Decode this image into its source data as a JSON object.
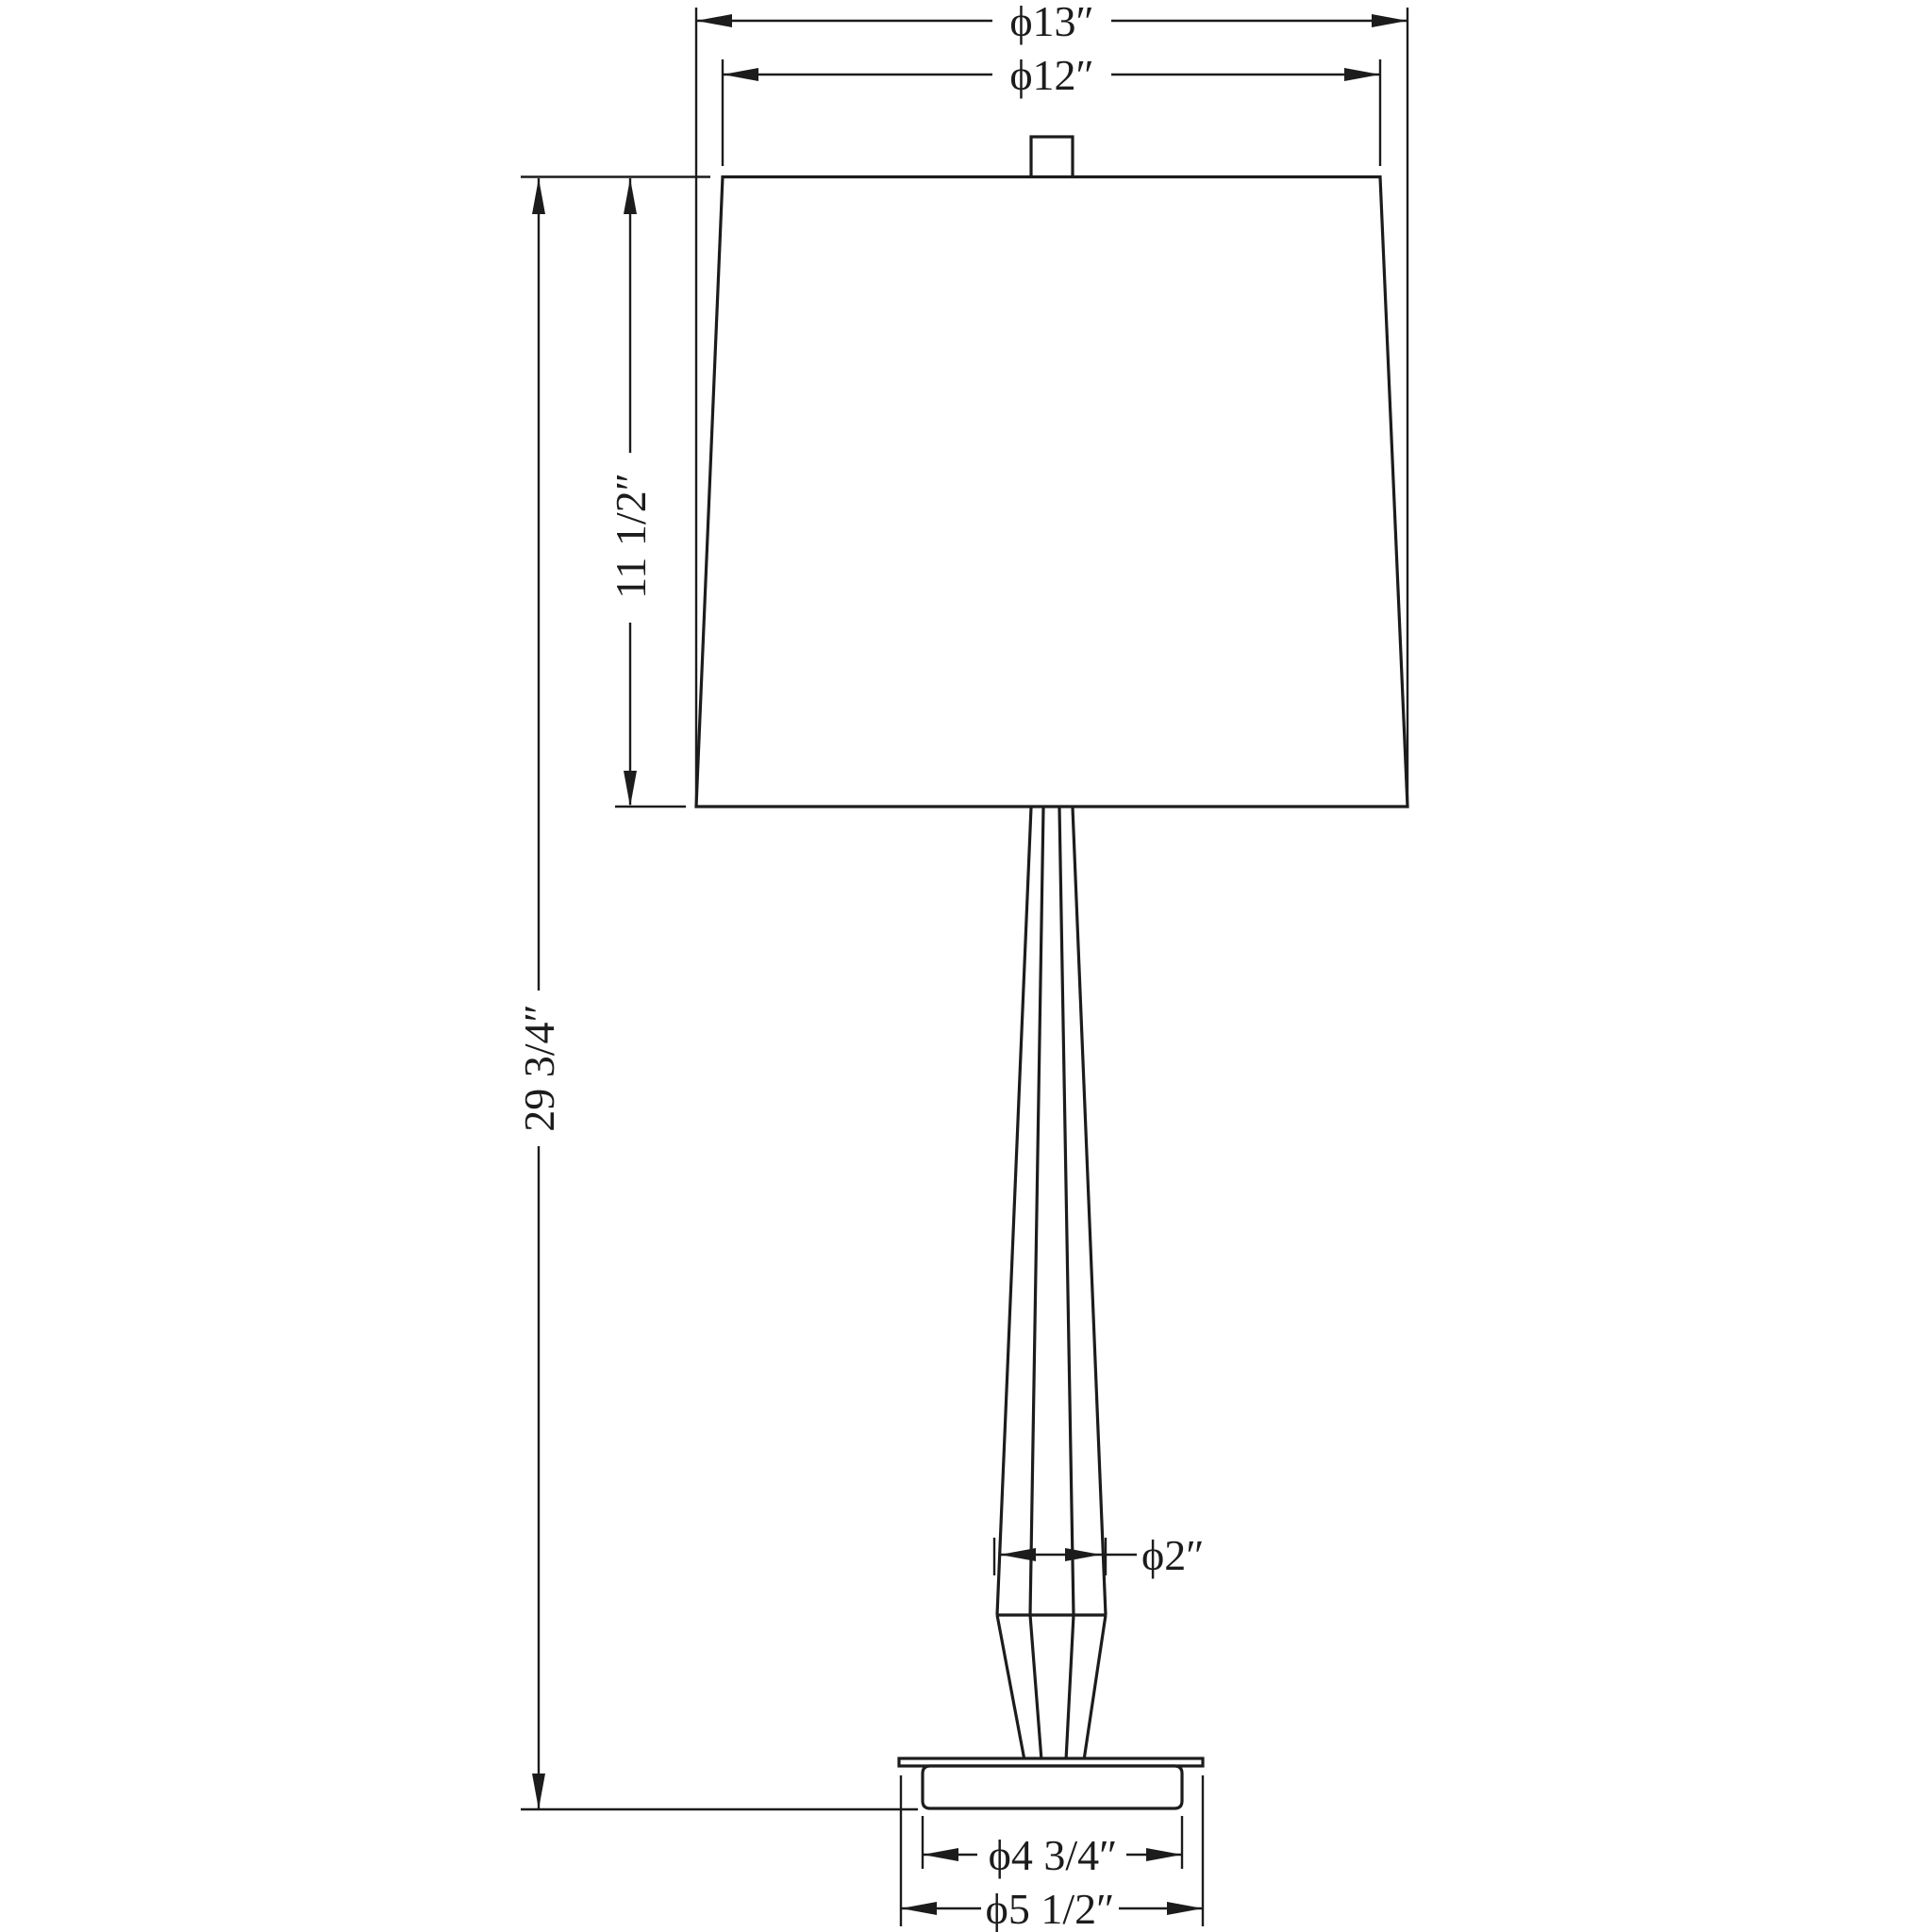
{
  "canvas": {
    "background": "#ffffff",
    "line_color": "#1c1c1c"
  },
  "drawing": {
    "dimensions": {
      "shade_bottom_diameter": "ϕ13″",
      "shade_top_diameter": "ϕ12″",
      "shade_height": "11 1/2″",
      "overall_height": "29 3/4″",
      "stem_diameter": "ϕ2″",
      "base_body_diameter": "ϕ4 3/4″",
      "base_plate_diameter": "ϕ5 1/2″"
    }
  }
}
